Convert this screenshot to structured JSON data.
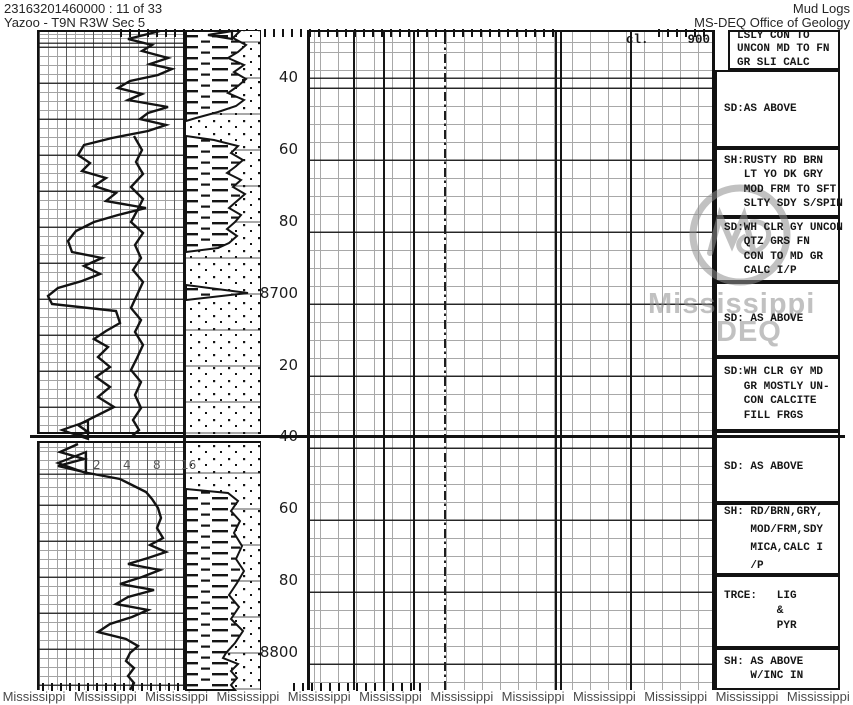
{
  "header": {
    "doc_id": "23163201460000 : 11 of 33",
    "location": "Yazoo - T9N R3W Sec 5",
    "title": "Mud Logs",
    "agency": "MS-DEQ Office of Geology"
  },
  "chart_data": {
    "type": "line",
    "description": "Scanned mud log strip: jagged drilling/penetration traces vs depth, lithology column (shale dashes / sand dots), depth scale in feet, and geologist sample descriptions.",
    "depth_unit": "ft",
    "depth_range": [
      8630,
      8810
    ],
    "depth_labels": [
      {
        "text": "40",
        "y": 78
      },
      {
        "text": "60",
        "y": 150
      },
      {
        "text": "80",
        "y": 222
      },
      {
        "text": "8700",
        "y": 294
      },
      {
        "text": "20",
        "y": 366
      },
      {
        "text": "40",
        "y": 437
      },
      {
        "text": "60",
        "y": 509
      },
      {
        "text": "80",
        "y": 581
      },
      {
        "text": "8800",
        "y": 653
      }
    ],
    "chloride": {
      "label": "cl.",
      "value": "900"
    },
    "scale_labels": [
      "2",
      "4",
      "8",
      "16"
    ],
    "series": [
      {
        "name": "trace-upper-main",
        "points": [
          [
            160,
            31
          ],
          [
            128,
            39
          ],
          [
            152,
            45
          ],
          [
            142,
            51
          ],
          [
            168,
            58
          ],
          [
            150,
            64
          ],
          [
            172,
            69
          ],
          [
            158,
            75
          ],
          [
            130,
            81
          ],
          [
            118,
            88
          ],
          [
            142,
            94
          ],
          [
            128,
            100
          ],
          [
            168,
            107
          ],
          [
            148,
            113
          ],
          [
            140,
            119
          ],
          [
            166,
            125
          ],
          [
            148,
            131
          ],
          [
            112,
            138
          ],
          [
            84,
            145
          ],
          [
            78,
            155
          ],
          [
            90,
            163
          ],
          [
            82,
            171
          ],
          [
            106,
            178
          ],
          [
            94,
            186
          ],
          [
            116,
            193
          ],
          [
            106,
            201
          ],
          [
            146,
            208
          ],
          [
            118,
            215
          ],
          [
            94,
            222
          ],
          [
            76,
            231
          ],
          [
            68,
            241
          ],
          [
            72,
            252
          ],
          [
            102,
            258
          ],
          [
            84,
            266
          ],
          [
            100,
            274
          ],
          [
            82,
            281
          ],
          [
            58,
            288
          ],
          [
            48,
            296
          ],
          [
            52,
            304
          ],
          [
            116,
            311
          ],
          [
            120,
            323
          ],
          [
            106,
            331
          ],
          [
            94,
            339
          ],
          [
            108,
            347
          ],
          [
            98,
            357
          ],
          [
            110,
            367
          ],
          [
            96,
            377
          ],
          [
            110,
            387
          ],
          [
            98,
            397
          ],
          [
            114,
            407
          ],
          [
            94,
            417
          ],
          [
            78,
            425
          ],
          [
            88,
            432
          ],
          [
            70,
            437
          ]
        ]
      },
      {
        "name": "trace-upper-secondary",
        "points": [
          [
            134,
            136
          ],
          [
            142,
            150
          ],
          [
            136,
            162
          ],
          [
            143,
            174
          ],
          [
            131,
            187
          ],
          [
            143,
            199
          ],
          [
            137,
            211
          ],
          [
            131,
            222
          ],
          [
            143,
            233
          ],
          [
            135,
            245
          ],
          [
            141,
            258
          ],
          [
            133,
            270
          ],
          [
            143,
            282
          ],
          [
            137,
            295
          ],
          [
            131,
            308
          ],
          [
            141,
            320
          ],
          [
            135,
            332
          ],
          [
            143,
            345
          ],
          [
            137,
            358
          ],
          [
            131,
            370
          ],
          [
            141,
            382
          ],
          [
            135,
            395
          ],
          [
            141,
            408
          ],
          [
            133,
            420
          ],
          [
            139,
            430
          ],
          [
            131,
            437
          ]
        ]
      },
      {
        "name": "trace-lower-main",
        "points": [
          [
            78,
            444
          ],
          [
            60,
            452
          ],
          [
            84,
            459
          ],
          [
            58,
            466
          ],
          [
            88,
            473
          ],
          [
            120,
            479
          ],
          [
            132,
            485
          ],
          [
            146,
            492
          ],
          [
            152,
            499
          ],
          [
            158,
            508
          ],
          [
            161,
            518
          ],
          [
            157,
            528
          ],
          [
            163,
            538
          ],
          [
            150,
            545
          ],
          [
            166,
            552
          ],
          [
            148,
            558
          ],
          [
            128,
            564
          ],
          [
            160,
            570
          ],
          [
            142,
            577
          ],
          [
            120,
            584
          ],
          [
            154,
            590
          ],
          [
            128,
            597
          ],
          [
            116,
            604
          ],
          [
            148,
            610
          ],
          [
            132,
            617
          ],
          [
            110,
            624
          ],
          [
            98,
            632
          ],
          [
            126,
            639
          ],
          [
            138,
            646
          ],
          [
            130,
            653
          ],
          [
            126,
            661
          ],
          [
            134,
            668
          ],
          [
            128,
            676
          ],
          [
            134,
            683
          ],
          [
            130,
            690
          ]
        ]
      }
    ],
    "arrows": [
      {
        "name": "arrow-upper",
        "points": [
          [
            88,
            421
          ],
          [
            62,
            430
          ],
          [
            88,
            439
          ]
        ]
      },
      {
        "name": "arrow-lower",
        "points": [
          [
            86,
            452
          ],
          [
            58,
            463
          ],
          [
            86,
            473
          ]
        ]
      },
      {
        "name": "arrow-topruler",
        "points": [
          [
            232,
            31
          ],
          [
            208,
            35
          ],
          [
            232,
            39
          ]
        ]
      }
    ],
    "lithology": [
      {
        "name": "sand-upper",
        "pattern": "dots",
        "rect": [
          186,
          31,
          74,
          403
        ]
      },
      {
        "name": "sand-lower",
        "pattern": "dots",
        "rect": [
          186,
          443,
          74,
          247
        ]
      },
      {
        "name": "shale-upper-a",
        "pattern": "dashes",
        "points": [
          [
            186,
            31
          ],
          [
            240,
            31
          ],
          [
            233,
            38
          ],
          [
            246,
            45
          ],
          [
            238,
            52
          ],
          [
            228,
            58
          ],
          [
            244,
            65
          ],
          [
            234,
            72
          ],
          [
            246,
            79
          ],
          [
            238,
            86
          ],
          [
            228,
            93
          ],
          [
            244,
            100
          ],
          [
            236,
            106
          ],
          [
            218,
            112
          ],
          [
            196,
            118
          ],
          [
            186,
            121
          ]
        ]
      },
      {
        "name": "shale-upper-b",
        "pattern": "dashes",
        "points": [
          [
            186,
            136
          ],
          [
            214,
            140
          ],
          [
            238,
            146
          ],
          [
            231,
            153
          ],
          [
            243,
            160
          ],
          [
            235,
            167
          ],
          [
            227,
            173
          ],
          [
            241,
            180
          ],
          [
            233,
            187
          ],
          [
            245,
            194
          ],
          [
            237,
            201
          ],
          [
            229,
            208
          ],
          [
            241,
            215
          ],
          [
            235,
            222
          ],
          [
            227,
            229
          ],
          [
            237,
            236
          ],
          [
            229,
            243
          ],
          [
            218,
            248
          ],
          [
            186,
            252
          ]
        ]
      },
      {
        "name": "shale-wedge",
        "pattern": "dashes",
        "points": [
          [
            186,
            285
          ],
          [
            248,
            293
          ],
          [
            186,
            300
          ]
        ]
      },
      {
        "name": "shale-lower",
        "pattern": "dashes",
        "points": [
          [
            186,
            489
          ],
          [
            228,
            493
          ],
          [
            238,
            501
          ],
          [
            231,
            511
          ],
          [
            240,
            521
          ],
          [
            234,
            533
          ],
          [
            242,
            546
          ],
          [
            236,
            559
          ],
          [
            244,
            571
          ],
          [
            237,
            583
          ],
          [
            229,
            595
          ],
          [
            239,
            607
          ],
          [
            231,
            619
          ],
          [
            243,
            631
          ],
          [
            235,
            643
          ],
          [
            226,
            653
          ],
          [
            223,
            658
          ],
          [
            238,
            664
          ],
          [
            231,
            671
          ],
          [
            237,
            678
          ],
          [
            231,
            685
          ],
          [
            235,
            690
          ],
          [
            186,
            690
          ]
        ]
      }
    ]
  },
  "descriptions": [
    {
      "top": 30,
      "height": 40,
      "inset": true,
      "lh": 13.5,
      "lines": [
        "LSLY CON TO",
        "UNCON MD TO FN",
        "GR SLI CALC"
      ]
    },
    {
      "top": 70,
      "height": 78,
      "lines": [
        "SD:AS ABOVE"
      ]
    },
    {
      "top": 148,
      "height": 69,
      "lines": [
        "SH:RUSTY RD BRN",
        "   LT YO DK GRY",
        "   MOD FRM TO SFT",
        "   SLTY SDY S/SPIN"
      ]
    },
    {
      "top": 217,
      "height": 65,
      "lines": [
        "SD:WH CLR GY UNCON",
        "   QTZ GRS FN",
        "   CON TO MD GR",
        "   CALC I/P"
      ]
    },
    {
      "top": 282,
      "height": 75,
      "lines": [
        "SD: AS ABOVE"
      ]
    },
    {
      "top": 357,
      "height": 74,
      "lines": [
        "SD:WH CLR GY MD",
        "   GR MOSTLY UN-",
        "   CON CALCITE",
        "   FILL FRGS"
      ]
    },
    {
      "top": 431,
      "height": 72,
      "lines": [
        "SD: AS ABOVE"
      ]
    },
    {
      "top": 503,
      "height": 72,
      "lh": 18,
      "lines": [
        "SH: RD/BRN,GRY,",
        "    MOD/FRM,SDY",
        "    MICA,CALC I",
        "    /P"
      ]
    },
    {
      "top": 575,
      "height": 73,
      "lh": 15,
      "lines": [
        "TRCE:   LIG",
        "        &",
        "        PYR"
      ]
    },
    {
      "top": 648,
      "height": 42,
      "lines": [
        "SH: AS ABOVE",
        "    W/INC IN"
      ]
    }
  ],
  "watermark": {
    "line1": "Mississippi",
    "line2": "DEQ",
    "bottom_text": "Mississippi",
    "bottom_count": 12
  },
  "colors": {
    "ink": "#161616",
    "grid_light": "#a6a6a6",
    "watermark_gray": "#8f8f8f"
  }
}
